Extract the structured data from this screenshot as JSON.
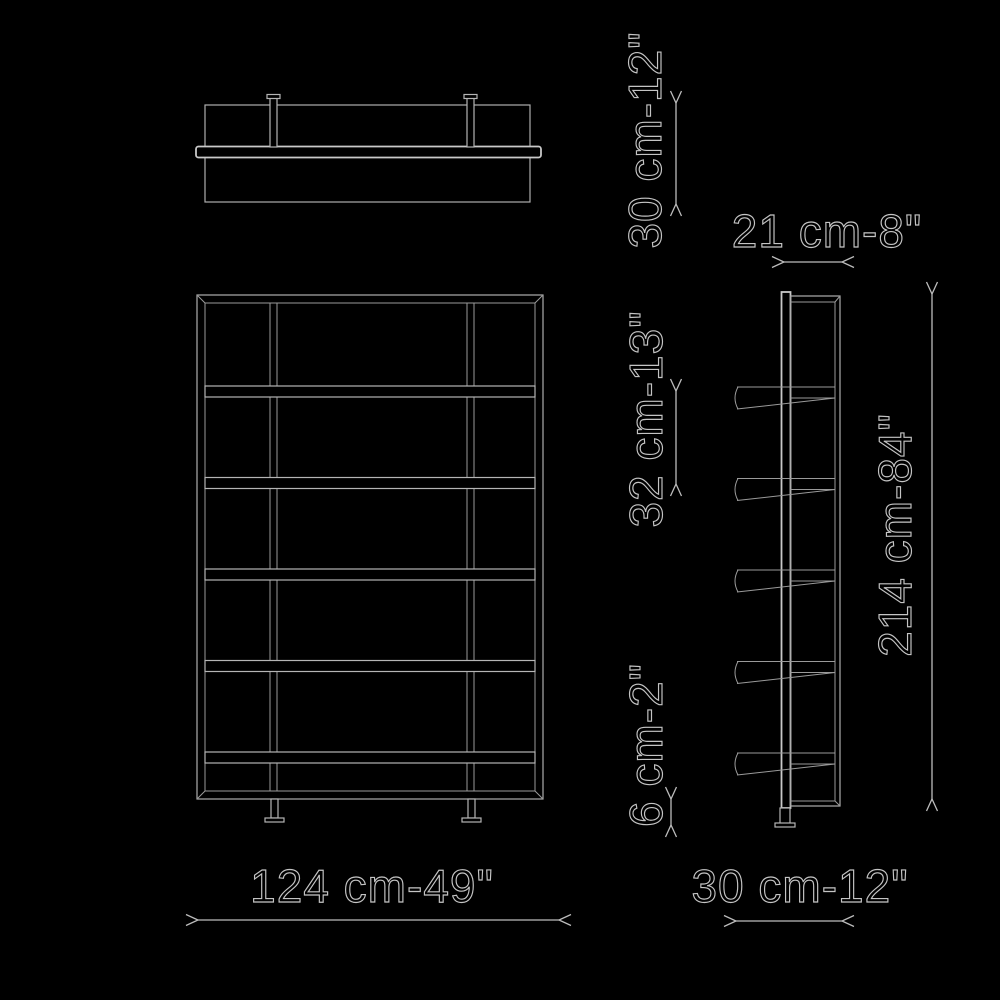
{
  "drawing": {
    "type": "furniture-dimension-diagram",
    "background_color": "#000000",
    "line_color": "#b5b5b5",
    "text_color": "#c4c4c4",
    "views": {
      "top_view": "plan view of shelf with back beam and two brackets",
      "front_view": "front elevation, 6 rows, 2 vertical dividers, 2 feet",
      "side_view": "side elevation with 5 protruding shelves and foot"
    },
    "labels": {
      "top_depth": "30 cm-12\"",
      "upper_depth": "21 cm-8\"",
      "shelf_spacing": "32 cm-13\"",
      "plinth_height": "6 cm-2\"",
      "total_height": "214 cm-84\"",
      "total_width": "124 cm-49\"",
      "side_depth": "30 cm-12\""
    }
  }
}
